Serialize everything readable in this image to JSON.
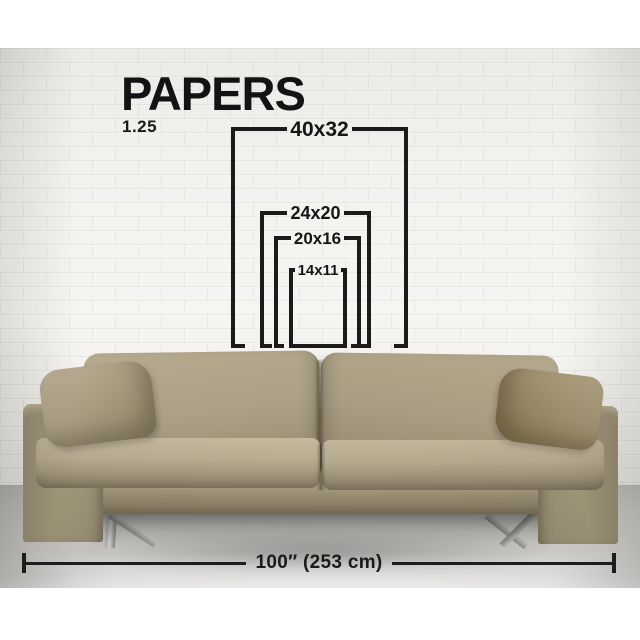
{
  "title": "PAPERS",
  "aspect_ratio_label": "1.25",
  "size_chart": {
    "sizes": [
      {
        "id": "40x32",
        "label": "40x32"
      },
      {
        "id": "24x20",
        "label": "24x20"
      },
      {
        "id": "20x16",
        "label": "20x16"
      },
      {
        "id": "14x11",
        "label": "14x11"
      }
    ]
  },
  "sofa_measure": {
    "label": "100″ (253 cm)"
  },
  "colors": {
    "ink": "#1b1b1b",
    "wall": "#f3f2ef",
    "floor": "#dcdbd8",
    "sofa_fabric": "#ab9f84",
    "pillow": "#9d8d6c",
    "leg_chrome": "#c9c9c7"
  }
}
